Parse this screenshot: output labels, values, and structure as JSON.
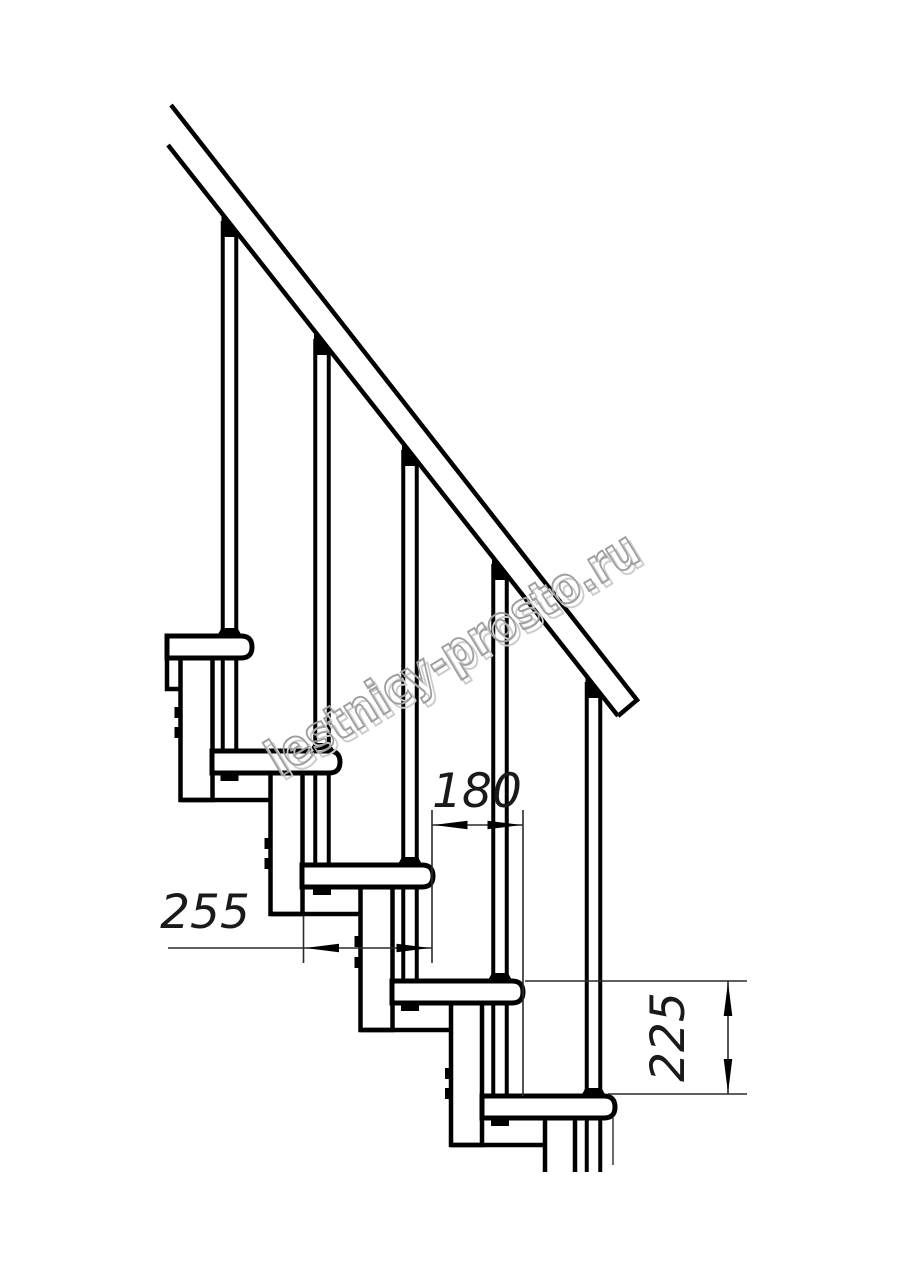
{
  "drawing": {
    "kind": "staircase-side-elevation",
    "dimensions": {
      "tread_depth": {
        "label": "255"
      },
      "tread_offset": {
        "label": "180"
      },
      "step_rise": {
        "label": "225"
      }
    },
    "watermark": {
      "text": "lestnicy-prosto.ru"
    },
    "colors": {
      "line": "#000000",
      "background": "#ffffff",
      "dim_text": "#1a1a1a",
      "watermark_outline": "#9f9f9f",
      "watermark_shadow": "#cccccc"
    }
  }
}
